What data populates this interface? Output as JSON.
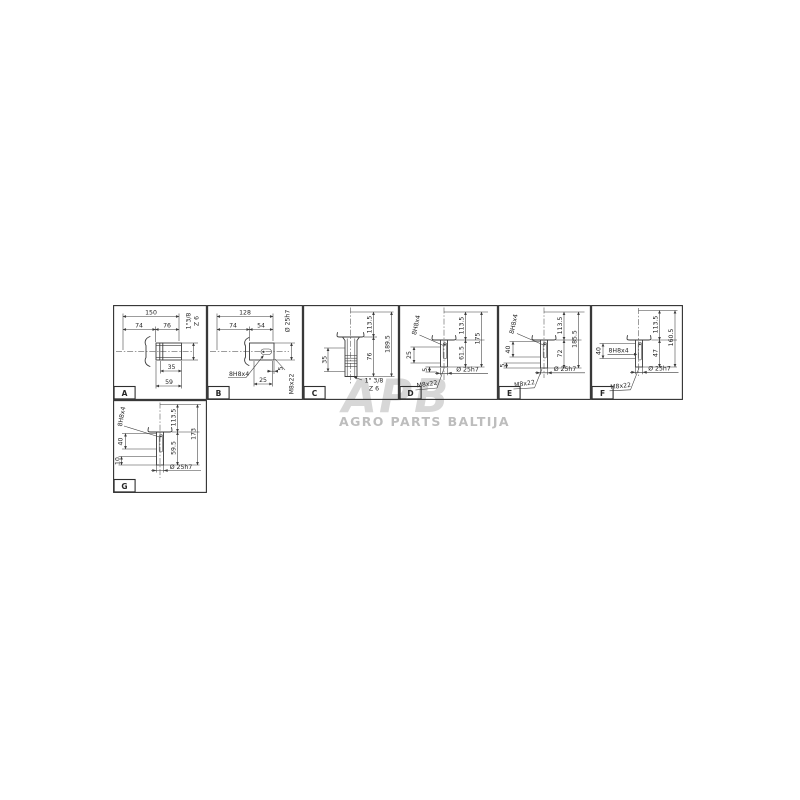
{
  "watermark": {
    "logo": "APB",
    "subtitle": "AGRO PARTS BALTIJA"
  },
  "panels": {
    "a": {
      "id": "A",
      "overall": "150",
      "seg1": "74",
      "seg2": "76",
      "spline": "1\"3/8",
      "teeth": "Z 6",
      "spline_len": "35",
      "hub_len": "59"
    },
    "b": {
      "id": "B",
      "overall": "128",
      "seg1": "74",
      "seg2": "54",
      "dia": "Ø 25h7",
      "keyway": "8H8x4",
      "key_len": "25",
      "tip": "5",
      "thread": "M8x22"
    },
    "c": {
      "id": "C",
      "upper": "113.5",
      "lower": "76",
      "overall": "189.5",
      "spline_len": "35",
      "spline": "1\" 3/8",
      "teeth": "Z 6"
    },
    "d": {
      "id": "D",
      "keyway": "8H8x4",
      "upper": "113.5",
      "lower": "61.5",
      "overall": "175",
      "key_len": "25",
      "tip": "5",
      "thread": "M8x22",
      "dia": "Ø 25h7"
    },
    "e": {
      "id": "E",
      "keyway": "8H8x4",
      "upper": "113.5",
      "lower": "72",
      "overall": "185.5",
      "key_len": "40",
      "tip": "5",
      "thread": "M8x22",
      "dia": "Ø 25h7"
    },
    "f": {
      "id": "F",
      "keyway": "8H8x4",
      "upper": "113.5",
      "lower": "47",
      "overall": "160.5",
      "key_len": "40",
      "thread": "M8x22",
      "dia": "Ø 25h7"
    },
    "g": {
      "id": "G",
      "keyway": "8H8x4",
      "upper": "113.5",
      "lower": "59.5",
      "overall": "173",
      "key_len": "40",
      "tip": "10",
      "dia": "Ø 25h7"
    }
  }
}
